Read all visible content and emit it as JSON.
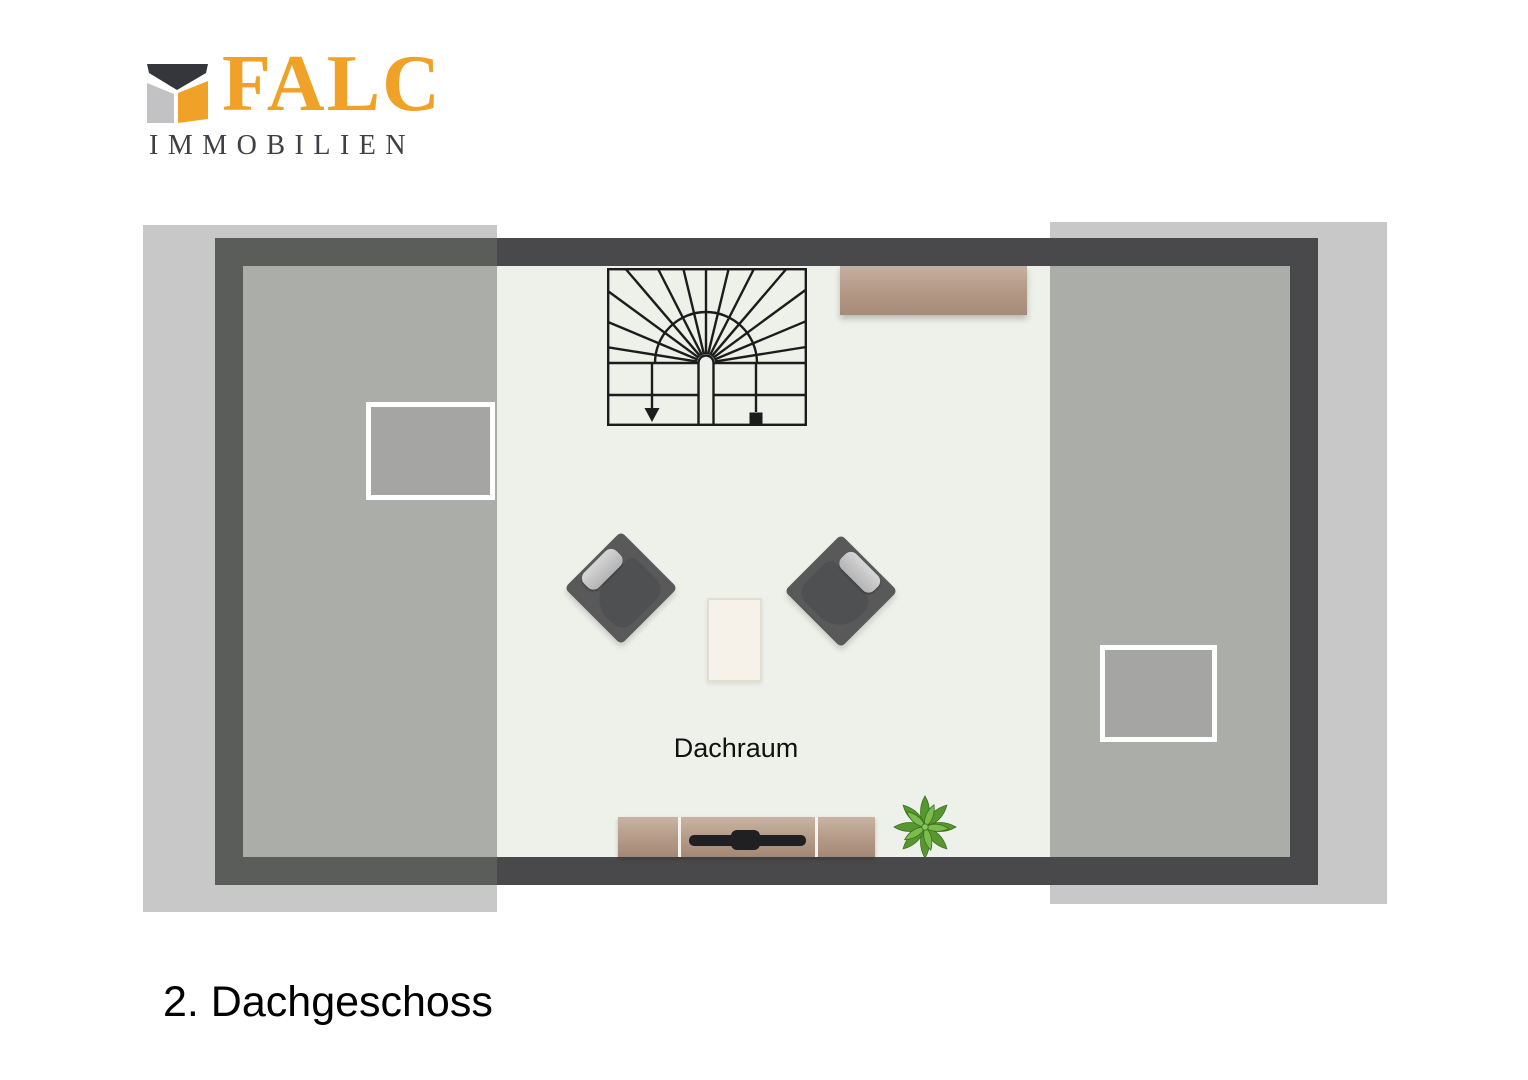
{
  "logo": {
    "brand": "FALC",
    "subtitle": "IMMOBILIEN"
  },
  "labels": {
    "room": "Dachraum",
    "floor": "2. Dachgeschoss"
  },
  "colors": {
    "brand_orange": "#f0a127",
    "logo_dark": "#35353c",
    "logo_gray": "#c2c2c4",
    "subtitle_gray": "#3f3f46",
    "overhang_gray": "#c8c8c8",
    "wall_dark": "#49494b",
    "wall_under_overlay": "#5b5d5a",
    "floor_light": "#eef0ea",
    "roof_slope_gray": "#abaea8",
    "skylight_fill": "#a5a5a3",
    "skylight_frame": "#ffffff",
    "stair_lines": "#1c1c1c",
    "wood": "#b29885",
    "chair_gray": "#59595a",
    "pillow_gray": "#c6c6c6",
    "table_cream": "#f6f2ea",
    "tv_black": "#202023",
    "plant_green": "#5f9e35"
  }
}
